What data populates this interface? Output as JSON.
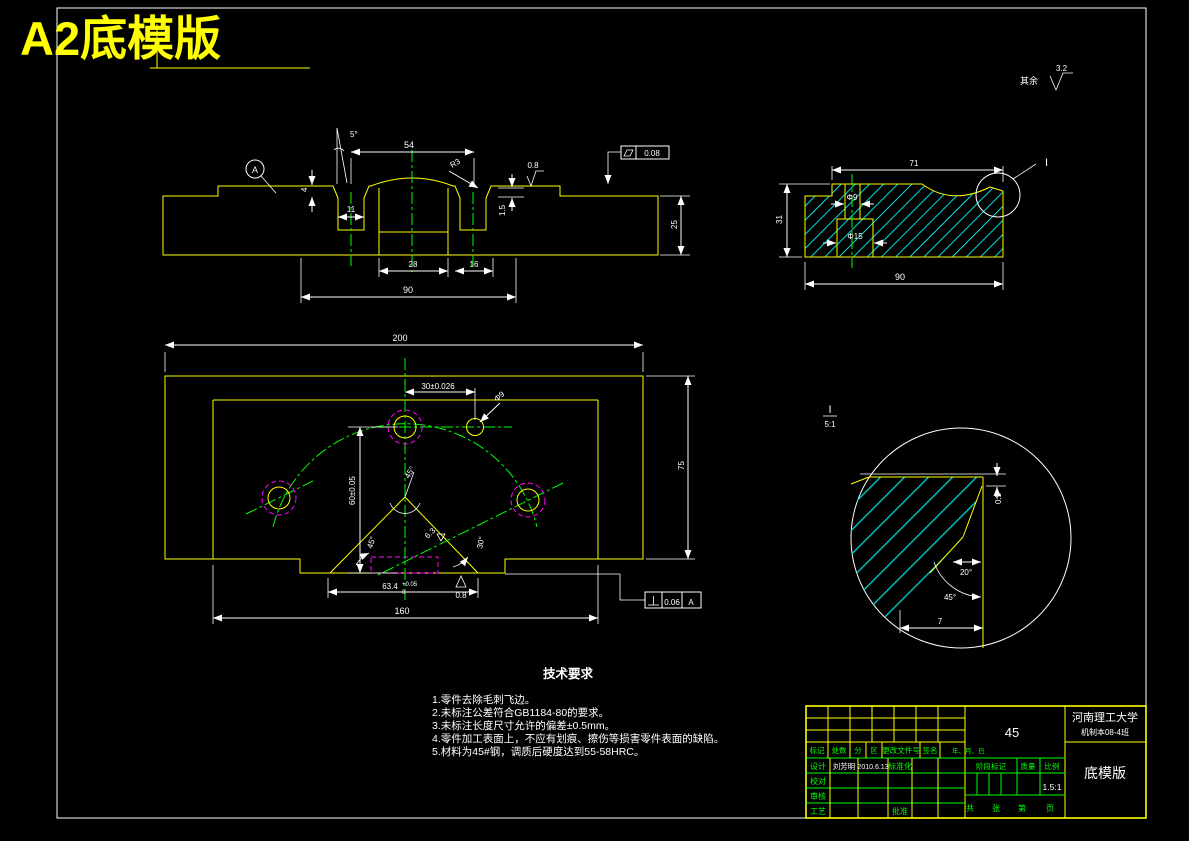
{
  "page": {
    "title": "A2底模版"
  },
  "colors": {
    "outline": "#ffff00",
    "centerline": "#00ff00",
    "hatch": "#00e0e0",
    "hidden": "#ff00ff",
    "dimension": "#ffffff",
    "background": "#000000"
  },
  "general": {
    "surplus_label": "其余",
    "surplus_roughness": "3.2"
  },
  "front_view": {
    "datum": "A",
    "dim_angle": "5°",
    "dim_54": "54",
    "dim_r3": "R3",
    "dim_4": "4",
    "dim_11": "11",
    "dim_1_5": "1.5",
    "dim_28": "28",
    "dim_16": "16",
    "dim_90": "90",
    "dim_25": "25",
    "roughness_top": "0.8",
    "flatness_value": "0.08"
  },
  "side_view": {
    "dim_71": "71",
    "dim_phi9": "Φ9",
    "dim_phi15": "Φ15",
    "dim_90": "90",
    "dim_31": "31",
    "detail_mark": "I"
  },
  "plan_view": {
    "dim_200": "200",
    "dim_75": "75",
    "dim_160": "160",
    "dim_30": "30±0.026",
    "dim_phi9": "Φ9",
    "dim_60": "60±0.05",
    "angle_apex": "45°",
    "angle_left": "45°",
    "angle_right": "30°",
    "dim_63_4": "63.4",
    "tol_upper": "+0.05",
    "tol_lower": "0",
    "roughness_bottom": "0.8",
    "roughness_incline": "6.3",
    "perp_value": "0.06",
    "perp_datum": "A"
  },
  "detail_view": {
    "label": "I",
    "scale": "5:1",
    "dim_0_5": "0.5",
    "angle_20": "20°",
    "angle_45": "45°",
    "dim_7": "7"
  },
  "tech_req": {
    "title": "技术要求",
    "items": [
      "1.零件去除毛刺飞边。",
      "2.未标注公差符合GB1184-80的要求。",
      "3.未标注长度尺寸允许的偏差±0.5mm。",
      "4.零件加工表面上，不应有划痕、擦伤等损害零件表面的缺陷。",
      "5.材料为45#钢，调质后硬度达到55-58HRC。"
    ]
  },
  "title_block": {
    "university": "河南理工大学",
    "class_name": "机制本08-4班",
    "part_name": "底模版",
    "material": "45",
    "scale": "1.5:1",
    "header_labels": {
      "mark": "标记",
      "count": "处数",
      "zone": "分",
      "region": "区",
      "doc_no": "更改文件号",
      "sign": "签名",
      "date": "年、月、日"
    },
    "roles": {
      "design": "设计",
      "check": "校对",
      "review": "审核",
      "process": "工艺",
      "approve": "批准",
      "standard": "标准化"
    },
    "designer_name": "刘芳明",
    "design_date": "2010.6.13",
    "stage_label": "阶段标记",
    "weight_label": "质量",
    "scale_label": "比例",
    "sheet_labels": {
      "total": "共",
      "sheets": "张",
      "no": "第",
      "page": "页"
    }
  }
}
